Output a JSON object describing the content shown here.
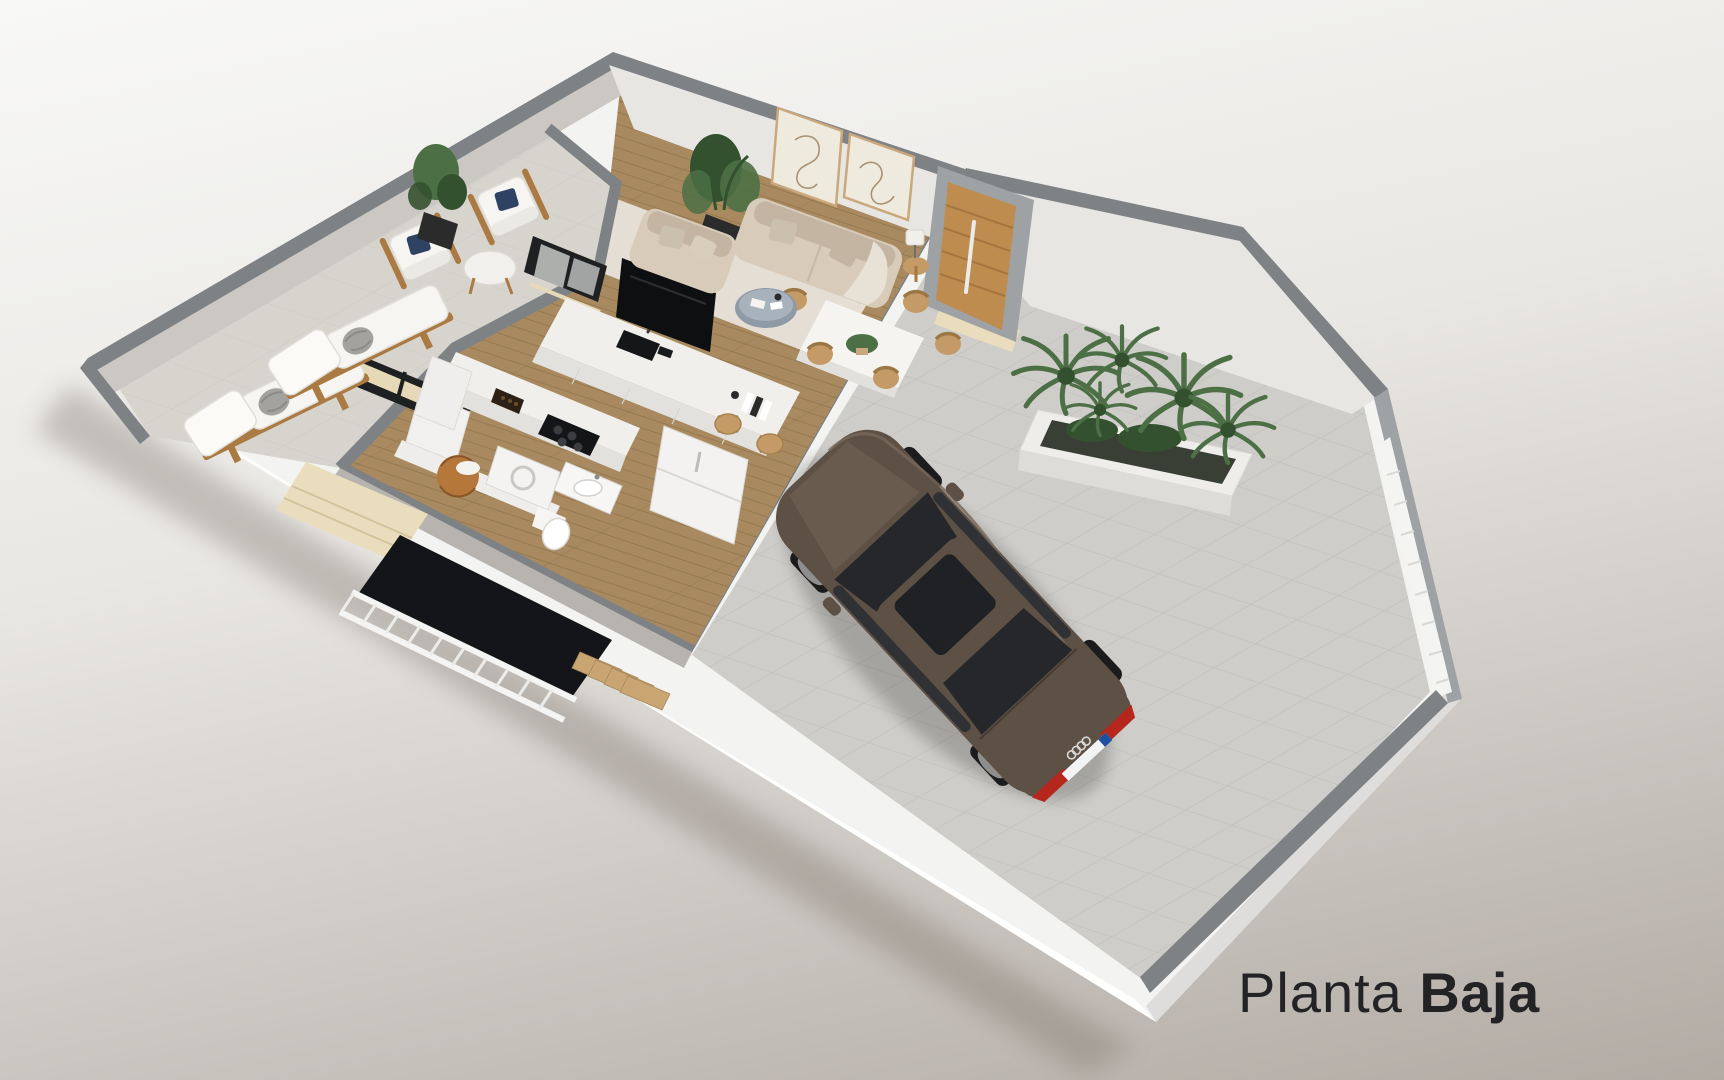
{
  "title": {
    "part1": "Planta ",
    "part2": "Baja"
  },
  "colors": {
    "bg_top": "#f8f8f7",
    "bg_mid": "#e9e7e3",
    "bg_bottom": "#b2aba4",
    "plinth": "#f3f3f1",
    "plinth_edge": "#dedddb",
    "wall_top": "#7e8285",
    "wall_top_light": "#9fa2a4",
    "wall_face": "#cbc8c4",
    "wall_face_light": "#e8e6e2",
    "wall_face_dark": "#b7b4b0",
    "terrace_tile": "#d7d4ce",
    "patio_tile": "#cfcdc9",
    "tile_line": "#bebcb7",
    "wood": "#a98a60",
    "wood_line": "#8e7149",
    "rug": "#e7e2d9",
    "marble": "#f1efeb",
    "cabinet": "#e3e1dd",
    "sofa": "#d8cbba",
    "sofa_dark": "#c3b5a2",
    "cushion": "#f6f5f2",
    "navy": "#2e4264",
    "wicker": "#c49a66",
    "wood_frame": "#ab7a42",
    "plant": "#4c6f45",
    "plant_dark": "#34512f",
    "pot": "#2a2b2a",
    "landing": "#e9ddbd",
    "stair_wood": "#c9a671",
    "railing": "#f4f4f2",
    "stairwell": "#141518",
    "door_wood": "#be8c4f",
    "car_body": "#5d5044",
    "car_body_light": "#77685a",
    "car_glass": "#26272a",
    "car_red": "#b5271d",
    "glass_frame": "#1e2022",
    "text": "#232325"
  },
  "scene": {
    "floor_shown": "ground floor 3D cutaway plan",
    "inventory": [
      {
        "item": "sun-lounger",
        "count": 2
      },
      {
        "item": "terrace-armchair",
        "count": 2
      },
      {
        "item": "terrace-side-table",
        "count": 1
      },
      {
        "item": "potted-tree",
        "count": 2
      },
      {
        "item": "sofa",
        "count": 2
      },
      {
        "item": "coffee-table",
        "count": 1
      },
      {
        "item": "wall-artwork",
        "count": 2
      },
      {
        "item": "table-lamp",
        "count": 1
      },
      {
        "item": "dining-table",
        "count": 1
      },
      {
        "item": "dining-chair",
        "count": 6
      },
      {
        "item": "tv",
        "count": 1
      },
      {
        "item": "kitchen-island",
        "count": 1
      },
      {
        "item": "bar-stool",
        "count": 2
      },
      {
        "item": "fridge",
        "count": 1
      },
      {
        "item": "cooktop",
        "count": 1
      },
      {
        "item": "washer",
        "count": 1
      },
      {
        "item": "toilet",
        "count": 1
      },
      {
        "item": "bathroom-sink",
        "count": 1
      },
      {
        "item": "staircase",
        "count": 1
      },
      {
        "item": "planter-box",
        "count": 1
      },
      {
        "item": "car",
        "count": 1
      }
    ],
    "car": {
      "type": "sedan",
      "badge": "four-rings",
      "plate_style": "eu"
    }
  }
}
